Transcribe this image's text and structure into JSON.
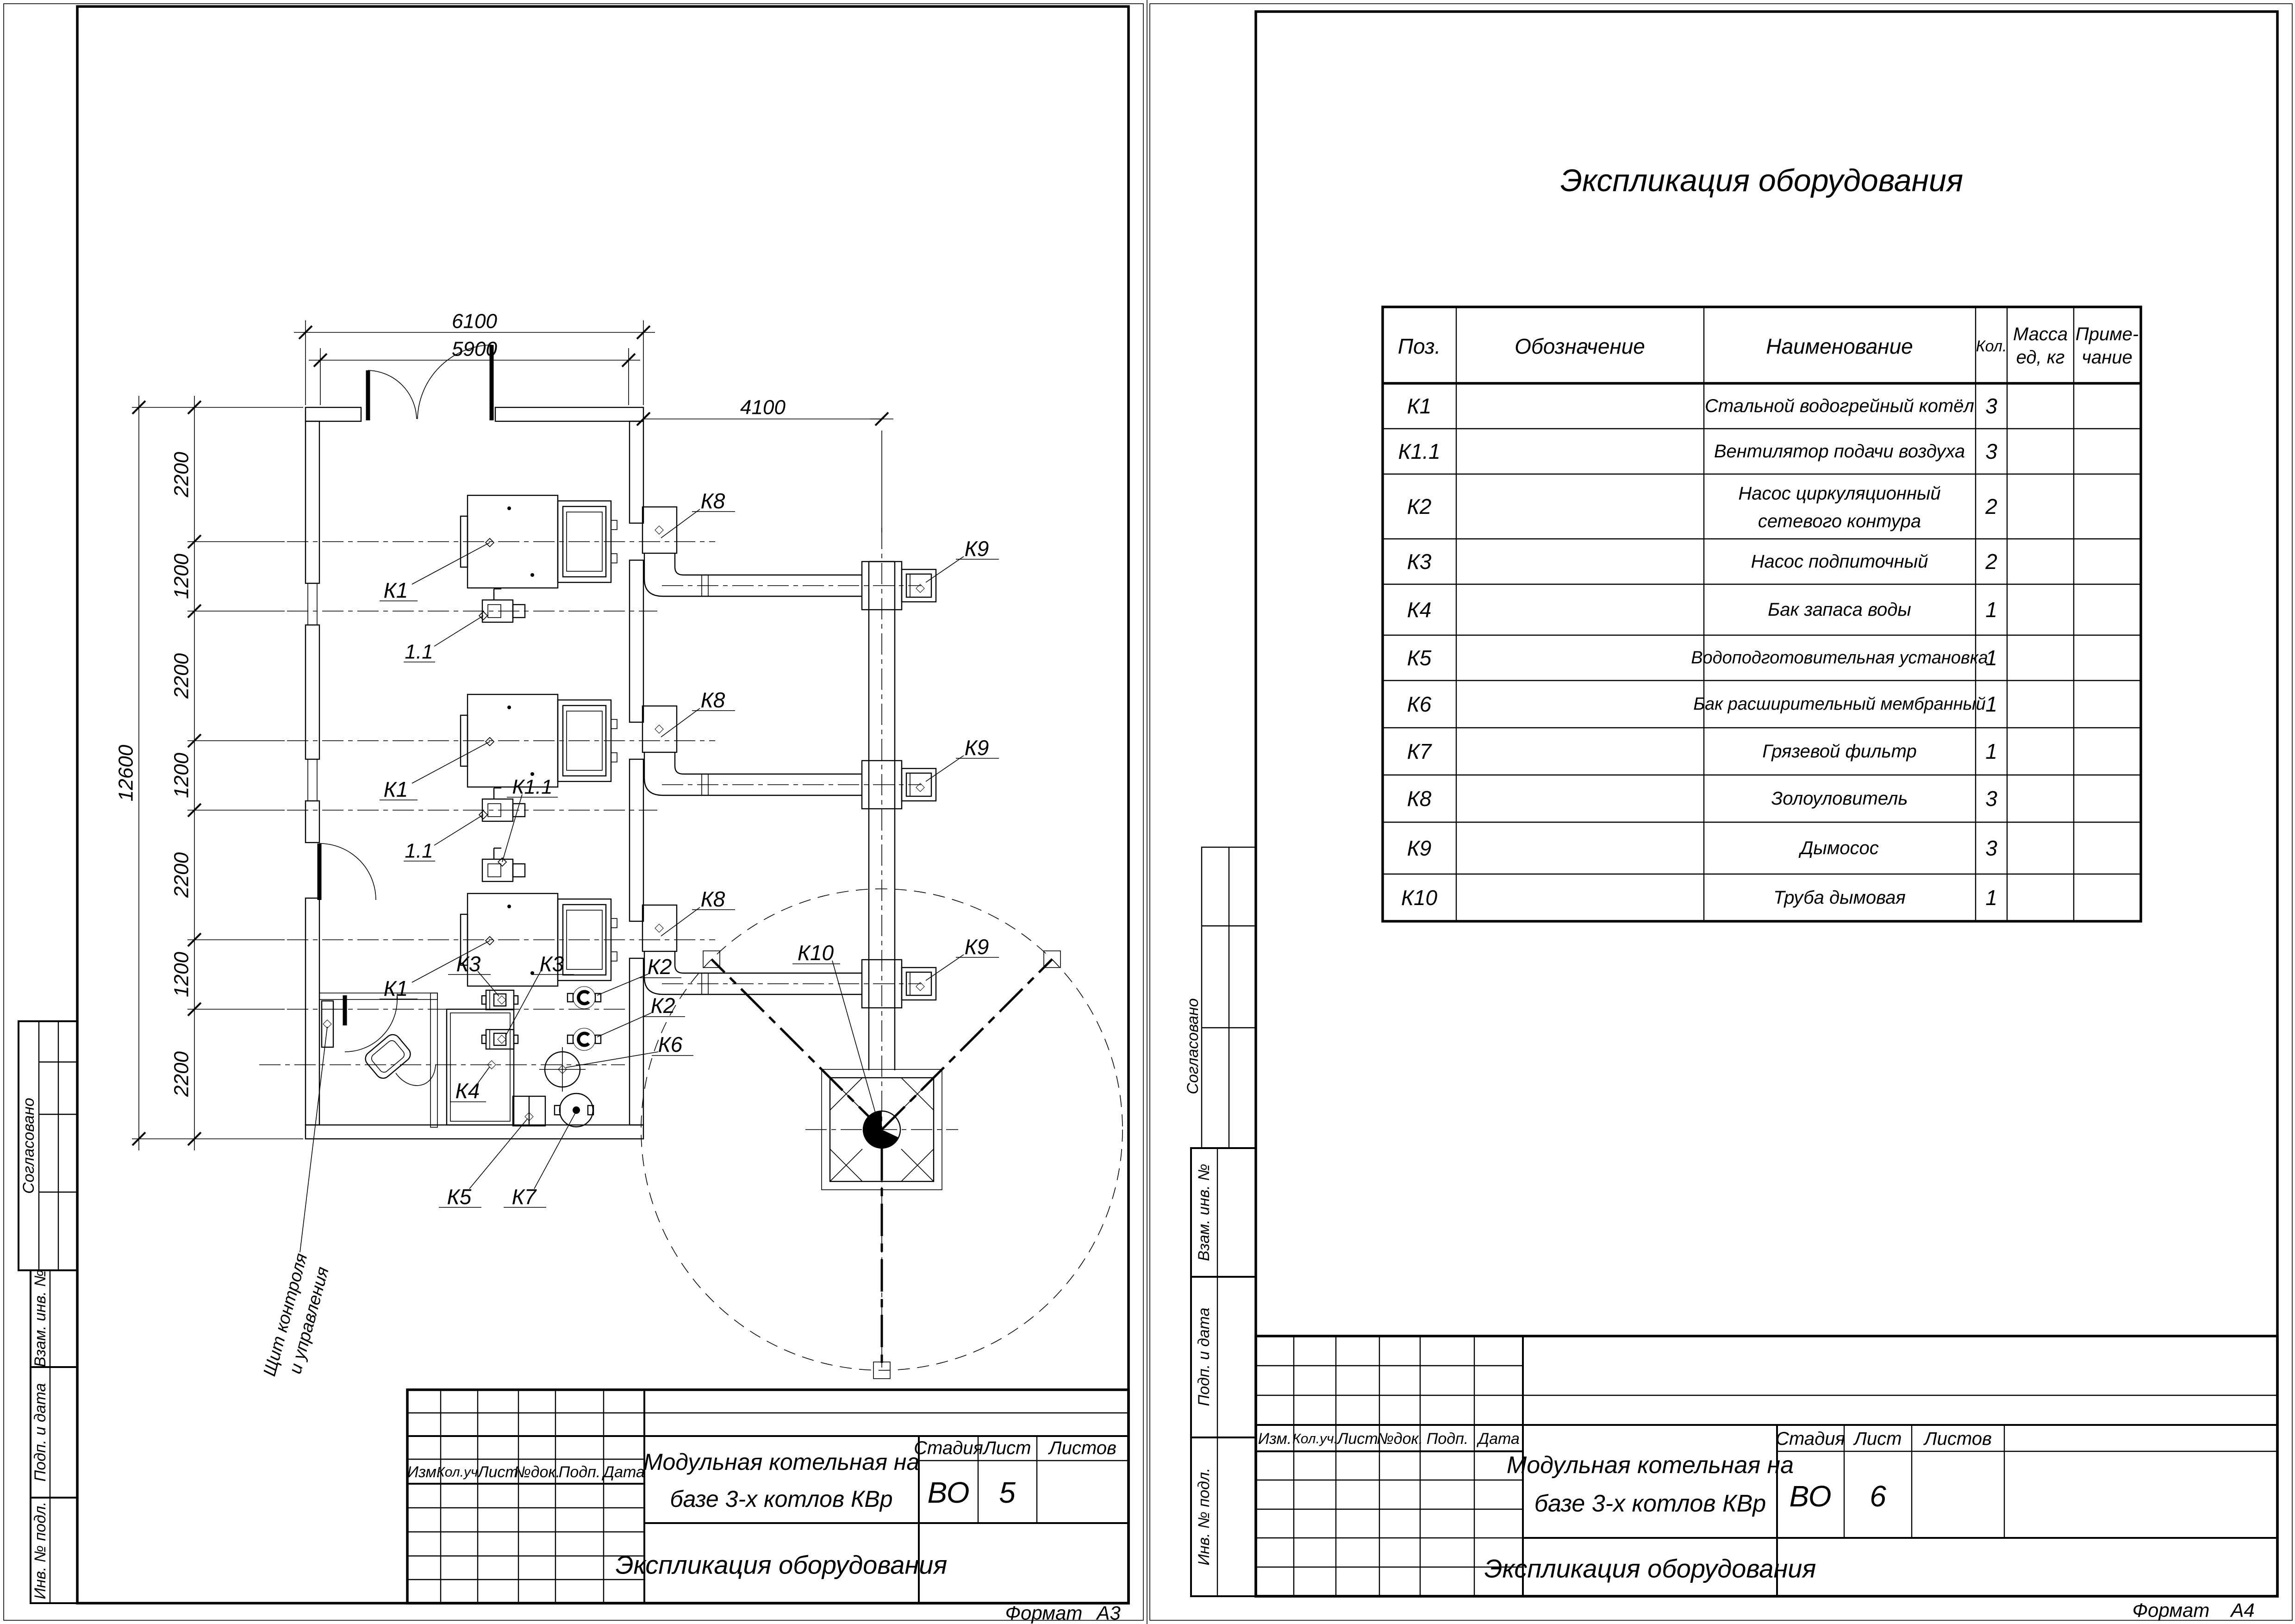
{
  "plan": {
    "dim_top_outer": "6100",
    "dim_top_inner": "5900",
    "dim_right": "4100",
    "dim_left_total": "12600",
    "dim_left_segments": [
      "2200",
      "1200",
      "2200",
      "1200",
      "2200",
      "1200",
      "2200"
    ],
    "labels": {
      "k1": "К1",
      "fan": "1.1",
      "k11": "К1.1",
      "k2": "К2",
      "k3": "К3",
      "k4": "К4",
      "k5": "К5",
      "k6": "К6",
      "k7": "К7",
      "k8": "К8",
      "k9": "К9",
      "k10": "К10"
    },
    "control_panel": {
      "line1": "Щит контроля",
      "line2": "и управления"
    }
  },
  "equipment_table": {
    "title": "Экспликация оборудования",
    "headers": {
      "pos": "Поз.",
      "designation": "Обозначение",
      "name": "Наименование",
      "qty": "Кол.",
      "mass1": "Масса",
      "mass2": "ед, кг",
      "note1": "Приме-",
      "note2": "чание"
    },
    "rows": [
      {
        "pos": "К1",
        "name": "Стальной водогрейный котёл",
        "qty": "3"
      },
      {
        "pos": "К1.1",
        "name": "Вентилятор подачи воздуха",
        "qty": "3"
      },
      {
        "pos": "К2",
        "name": "Насос циркуляционный",
        "name2": "сетевого контура",
        "qty": "2"
      },
      {
        "pos": "К3",
        "name": "Насос подпиточный",
        "qty": "2"
      },
      {
        "pos": "К4",
        "name": "Бак запаса воды",
        "qty": "1"
      },
      {
        "pos": "К5",
        "name": "Водоподготовительная установка",
        "qty": "1"
      },
      {
        "pos": "К6",
        "name": "Бак расширительный мембранный",
        "qty": "1"
      },
      {
        "pos": "К7",
        "name": "Грязевой фильтр",
        "qty": "1"
      },
      {
        "pos": "К8",
        "name": "Золоуловитель",
        "qty": "3"
      },
      {
        "pos": "К9",
        "name": "Дымосос",
        "qty": "3"
      },
      {
        "pos": "К10",
        "name": "Труба дымовая",
        "qty": "1"
      }
    ]
  },
  "title_block": {
    "project_line1": "Модульная котельная на",
    "project_line2": "базе 3-х котлов КВр",
    "doc_name": "Экспликация оборудования",
    "stage_label": "Стадия",
    "sheet_label": "Лист",
    "sheets_label": "Листов",
    "stage": "ВО",
    "sheet_a3": "5",
    "sheet_a4": "6",
    "rev": {
      "izm": "Изм.",
      "koluch": "Кол.уч.",
      "list": "Лист",
      "dok": "№док.",
      "podp": "Подп.",
      "data": "Дата"
    },
    "format_label": "Формат",
    "format_a3": "А3",
    "format_a4": "А4"
  },
  "side_stamp": {
    "soglasovano": "Согласовано",
    "vzam": "Взам. инв. №",
    "podp_data": "Подп. и дата",
    "inv_podl": "Инв. № подл."
  }
}
